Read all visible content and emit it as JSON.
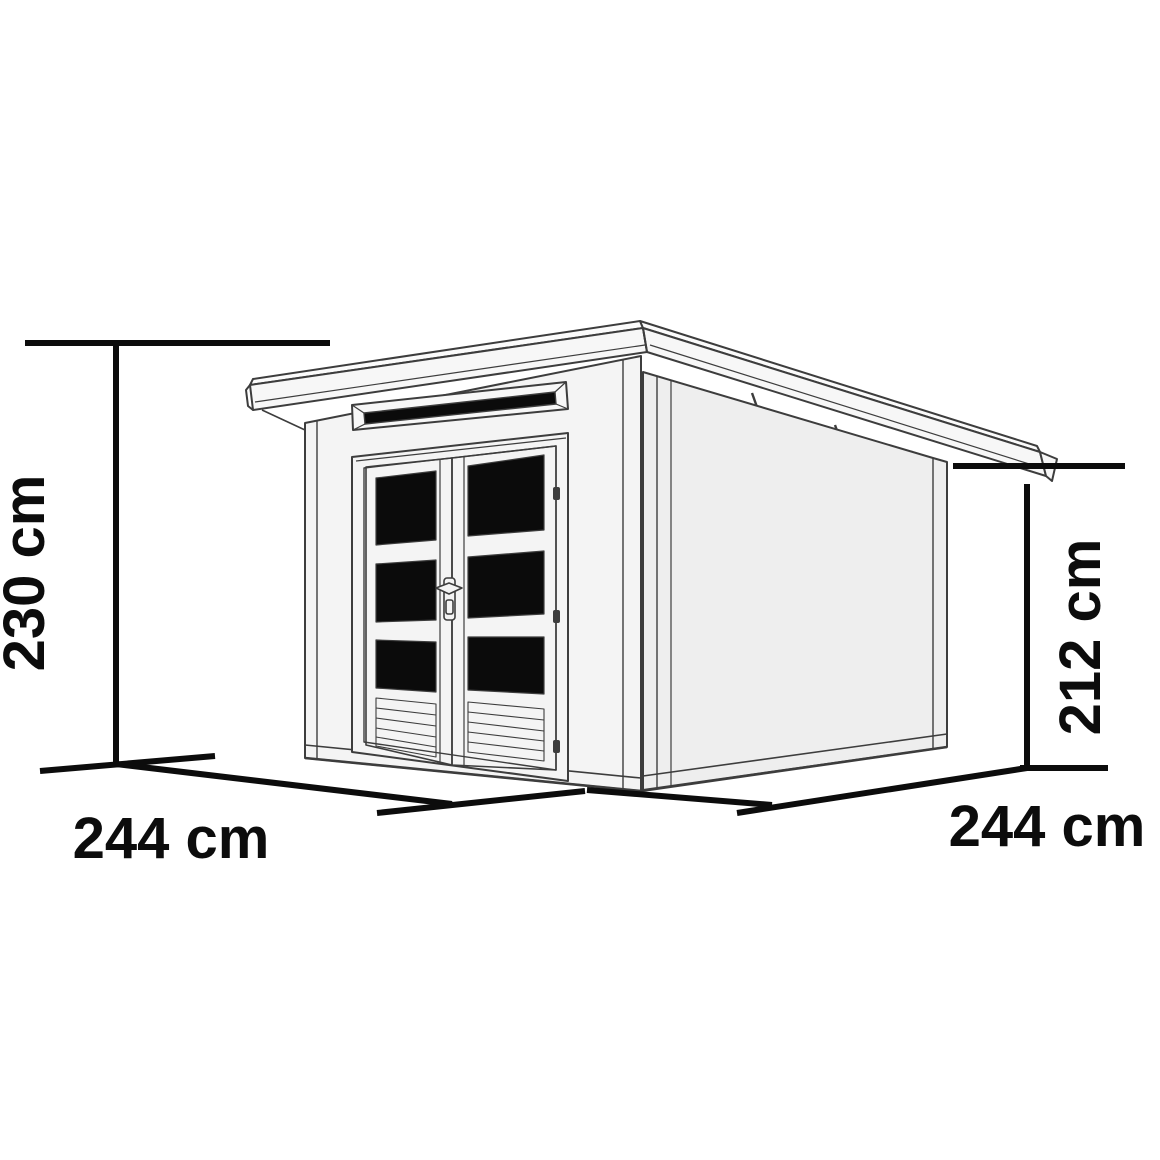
{
  "diagram": {
    "type": "product-dimension-line-drawing",
    "subject": "flat-roof (pent) garden shed with double glazed doors, transom window and side wall, drawn in perspective",
    "dimensions": {
      "height_left": "230 cm",
      "height_right": "212 cm",
      "width_front": "244 cm",
      "depth_side": "244 cm"
    },
    "colors": {
      "background": "#ffffff",
      "outline": "#3d3d3d",
      "dimension_line": "#0c0c0c",
      "glass": "#0b0b0b",
      "wall_front": "#f4f4f4",
      "wall_side": "#eeeeee",
      "roof": "#f7f7f7"
    },
    "features": [
      "roof overhang with fascia",
      "three roof brackets under right eave",
      "transom window above doors",
      "double doors with three dark glass panes each",
      "louvered vent slats at door bottoms",
      "door handle and hinges"
    ]
  }
}
